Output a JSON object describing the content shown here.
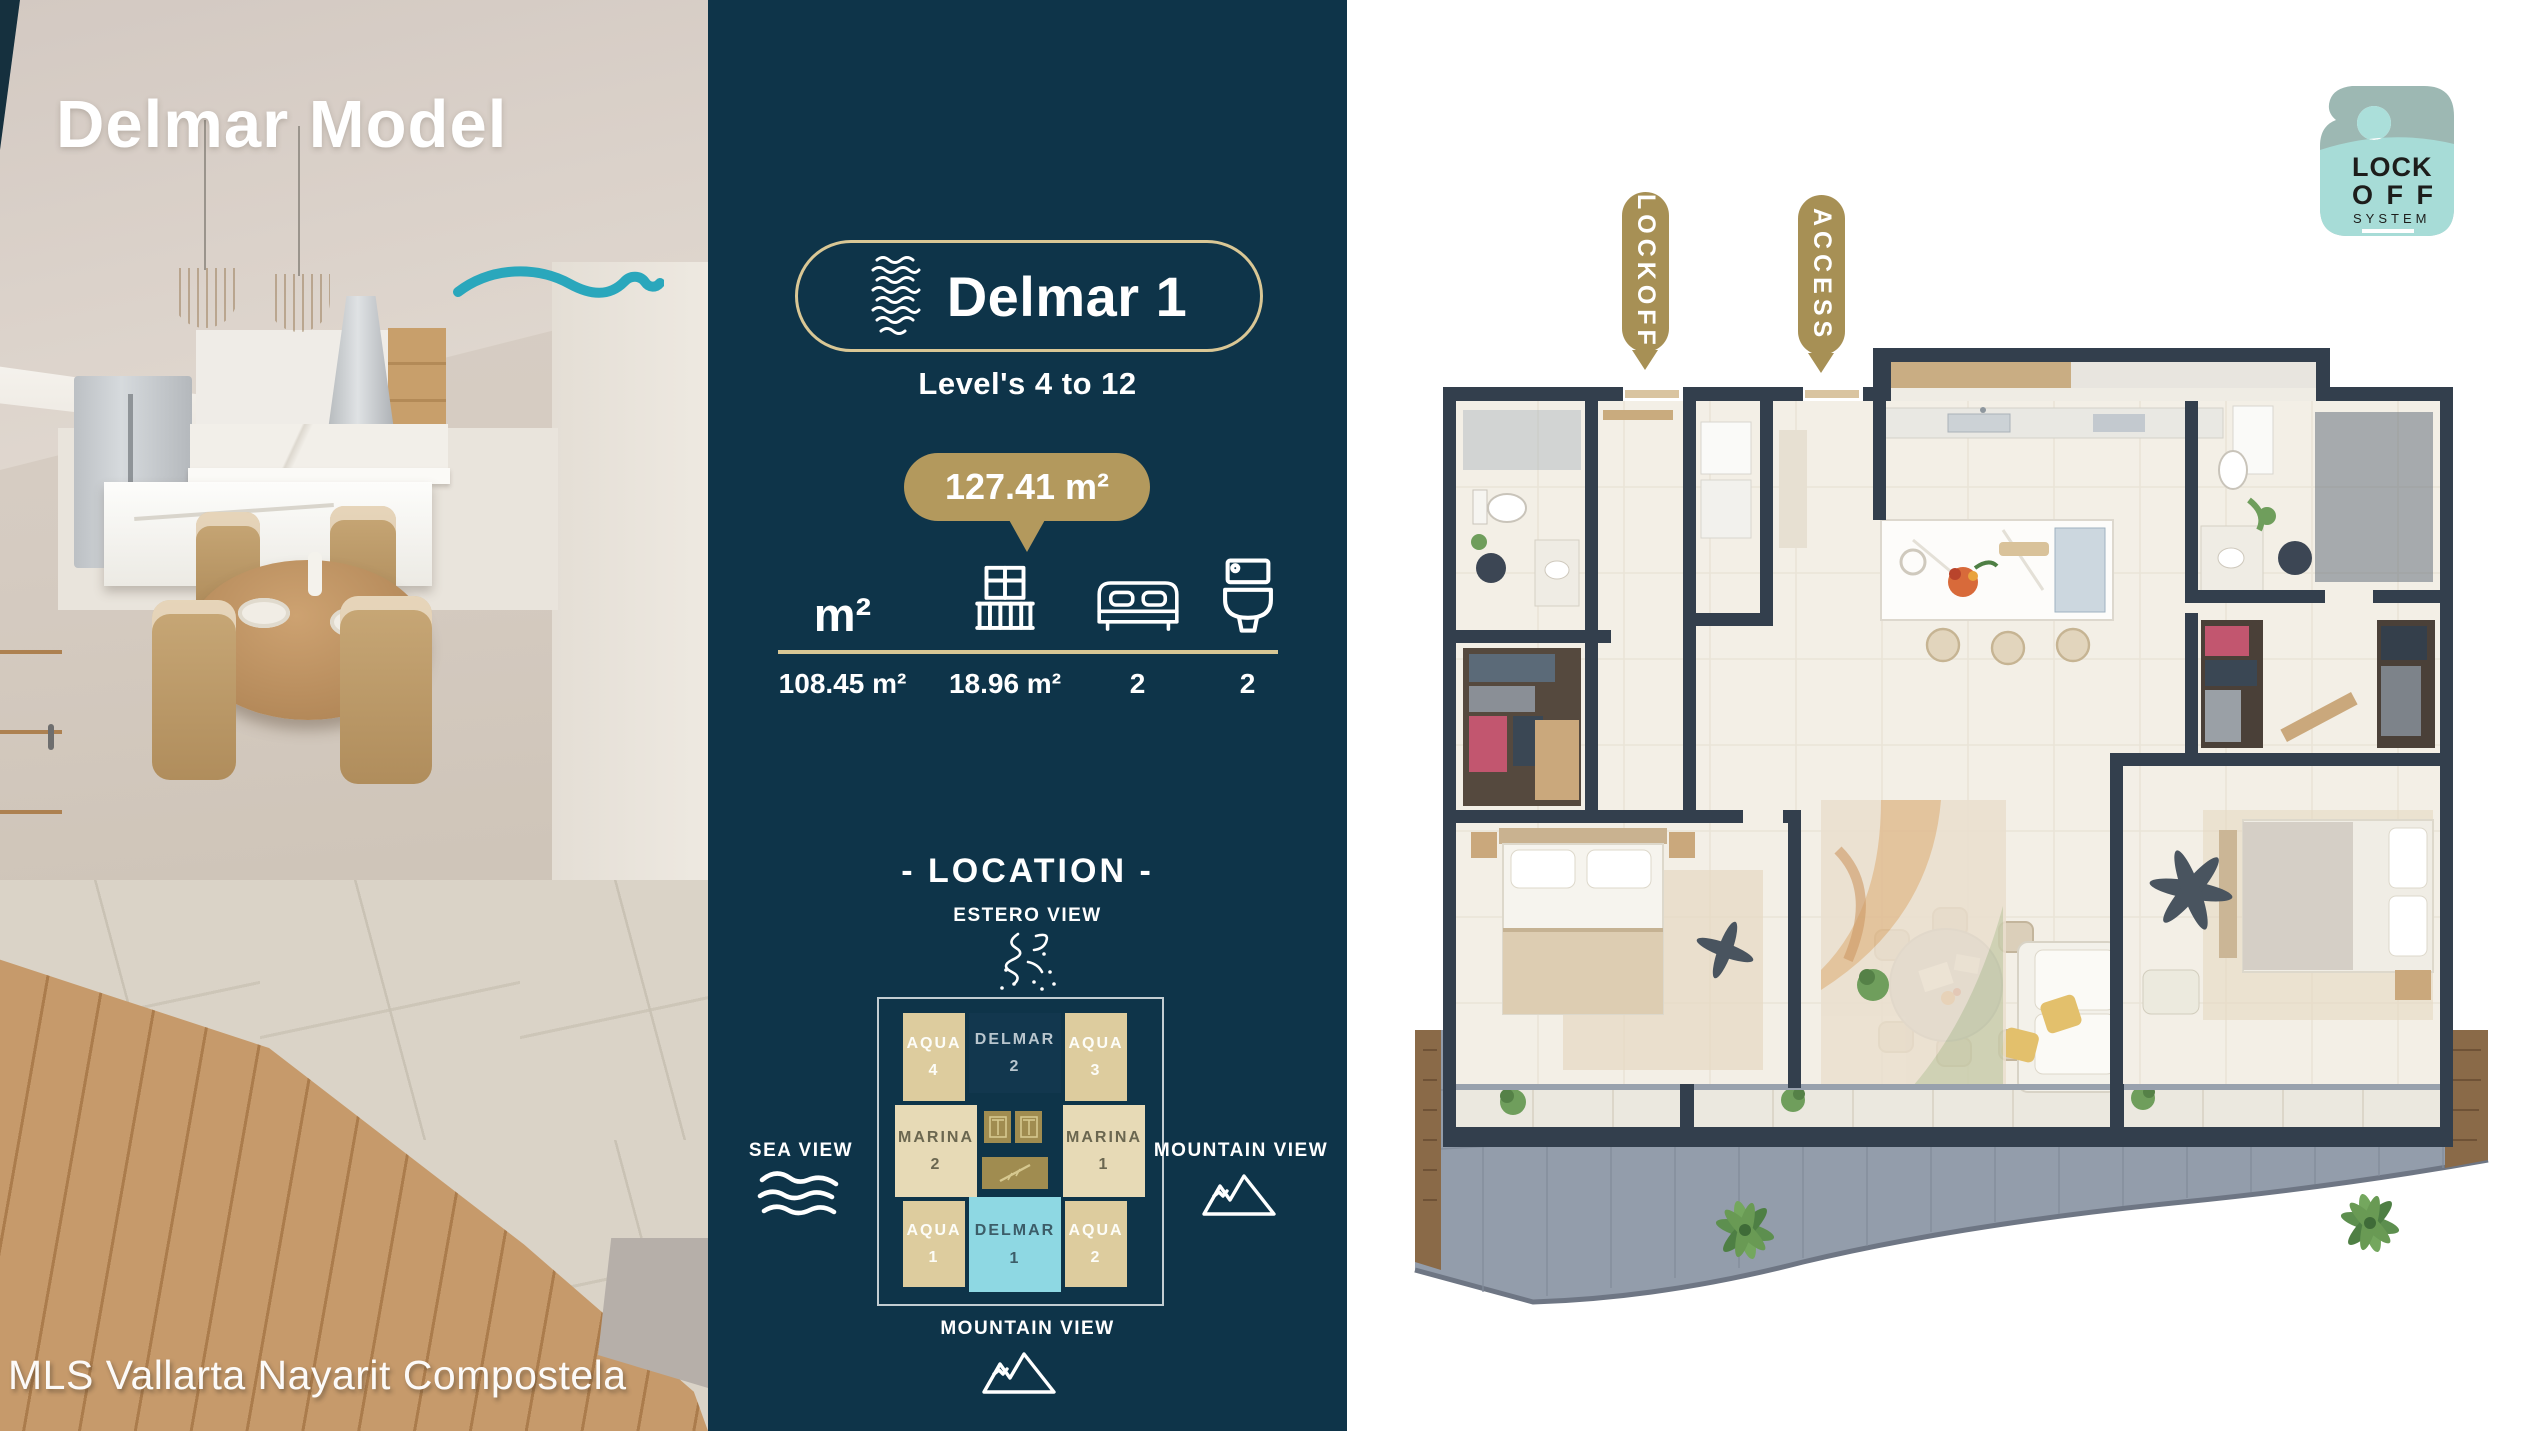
{
  "photo": {
    "title": "Delmar Model",
    "watermark": "MLS Vallarta Nayarit Compostela"
  },
  "unit": {
    "name": "Delmar 1",
    "levels": "Level's 4 to 12",
    "total_area": "127.41 m²",
    "specs": [
      {
        "icon": "area-icon",
        "label": "m²",
        "value": "108.45 m²"
      },
      {
        "icon": "balcony-icon",
        "value": "18.96 m²"
      },
      {
        "icon": "bed-icon",
        "value": "2"
      },
      {
        "icon": "toilet-icon",
        "value": "2"
      }
    ]
  },
  "location": {
    "title": "- LOCATION -",
    "views": {
      "top": "ESTERO VIEW",
      "left": "SEA VIEW",
      "right": "MOUNTAIN VIEW",
      "bottom": "MOUNTAIN VIEW"
    },
    "cells": [
      {
        "label": "AQUA",
        "num": "4",
        "type": "aqua"
      },
      {
        "label": "DELMAR",
        "num": "2",
        "type": "delmar-dark"
      },
      {
        "label": "AQUA",
        "num": "3",
        "type": "aqua"
      },
      {
        "label": "MARINA",
        "num": "2",
        "type": "marina"
      },
      {
        "label": "MARINA",
        "num": "1",
        "type": "marina"
      },
      {
        "label": "AQUA",
        "num": "1",
        "type": "aqua"
      },
      {
        "label": "DELMAR",
        "num": "1",
        "type": "delmar-active"
      },
      {
        "label": "AQUA",
        "num": "2",
        "type": "aqua"
      }
    ]
  },
  "plan": {
    "tags": {
      "lockoff": "LOCKOFF",
      "access": "ACCESS"
    },
    "hanger": {
      "line1": "LOCK",
      "line2": "O F F",
      "line3": "SYSTEM"
    }
  },
  "colors": {
    "navy": "#0e3449",
    "gold": "#b3995d",
    "gold_light": "#d8c795",
    "teal_wave": "#2aa7bc",
    "cyan_cell": "#8ed8e3",
    "tan_cell": "#ddcc9e",
    "marina_cell": "#e7dab6",
    "wall_dark": "#333f4d",
    "terrace_gray": "#939dab"
  }
}
